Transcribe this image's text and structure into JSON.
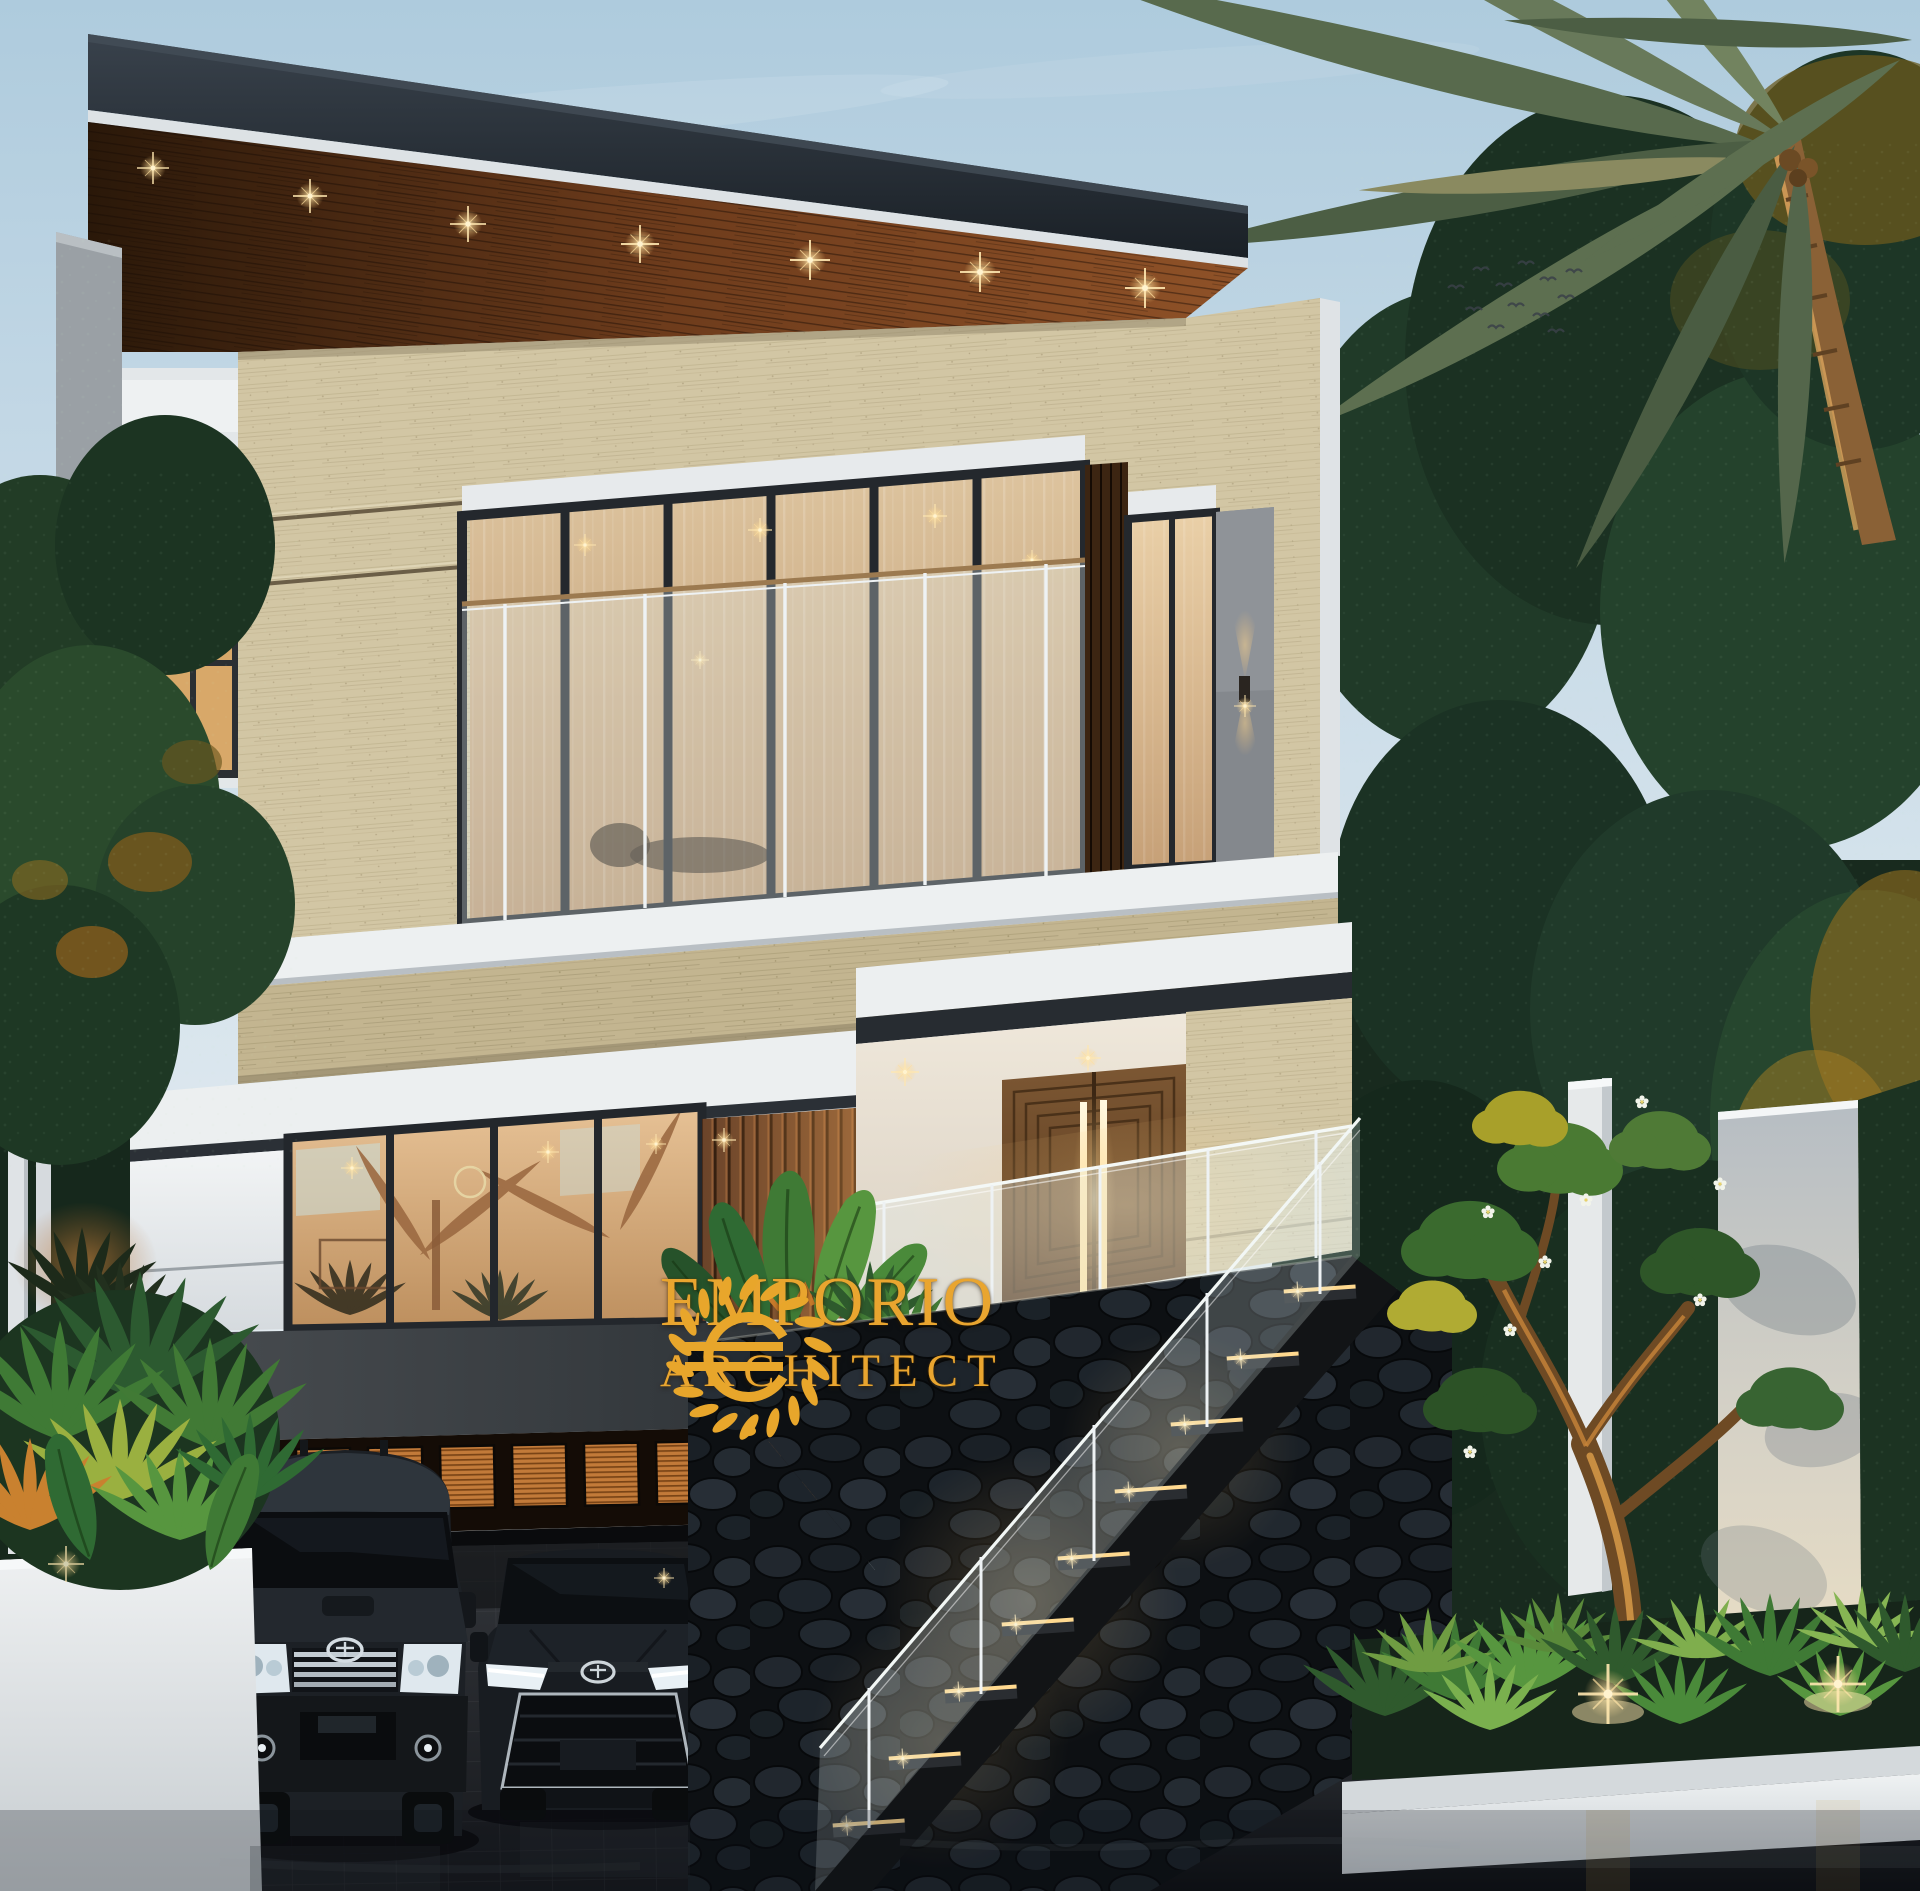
{
  "watermark": {
    "brand_line1": "EMPORIO",
    "brand_line2": "ARCHITECT",
    "logo_icon": "laurel-wreath-euro-monogram",
    "gold_color": "#E9A52F"
  },
  "scene": {
    "type": "architectural exterior render",
    "time_of_day": "dusk",
    "sky": {
      "top_color": "#aecbdd",
      "horizon_color": "#e9eef1",
      "birds_in_flock": 12
    },
    "building": {
      "floors": 3,
      "style": "modern tropical villa",
      "materials": [
        "travertine stone",
        "wood slats",
        "white concrete",
        "glass",
        "black lava stone",
        "grey andesite"
      ],
      "roof": {
        "fascia_color": "#20262d",
        "soffit": "wood planks",
        "recessed_downlights": 7
      },
      "second_floor": {
        "balcony_glass_panels": 6,
        "glass_balustrade_posts": 5,
        "wall_sconce_lamps": 1,
        "side_window_panels": 2
      },
      "first_floor": {
        "living_window_panels": 4,
        "entrance": "double wooden door with concentric pattern",
        "door_led_strips": 2,
        "terrace_railing": "frameless glass"
      },
      "garage": {
        "clerestory_windows": 10,
        "door_state": "open dark interior"
      }
    },
    "vehicles": [
      {
        "type": "SUV",
        "badge": "toyota-emblem",
        "color": "dark grey"
      },
      {
        "type": "sedan",
        "badge": "toyota-emblem",
        "color": "black"
      }
    ],
    "stairs": {
      "lit_steps": 9,
      "railing": "glass with steel posts",
      "wall": "black lava stone"
    },
    "landscape": {
      "coconut_palms": 1,
      "frangipani_trees": 1,
      "garden_uplights": 2,
      "white_boundary_walls": 2,
      "planter": "white concrete box with tropical plants",
      "lawn_strip_color": "#47662f",
      "driveway": "dark pavers with wet reflections"
    },
    "palette": {
      "travertine": "#d2c6a4",
      "wood": "#6b442a",
      "white_trim": "#eef0f2",
      "dark_fascia": "#23292f",
      "warm_light": "#ffdf9e",
      "lava_stone": "#161a1e",
      "foliage_dark": "#1c3322",
      "foliage_lit": "#b0a82e"
    }
  }
}
